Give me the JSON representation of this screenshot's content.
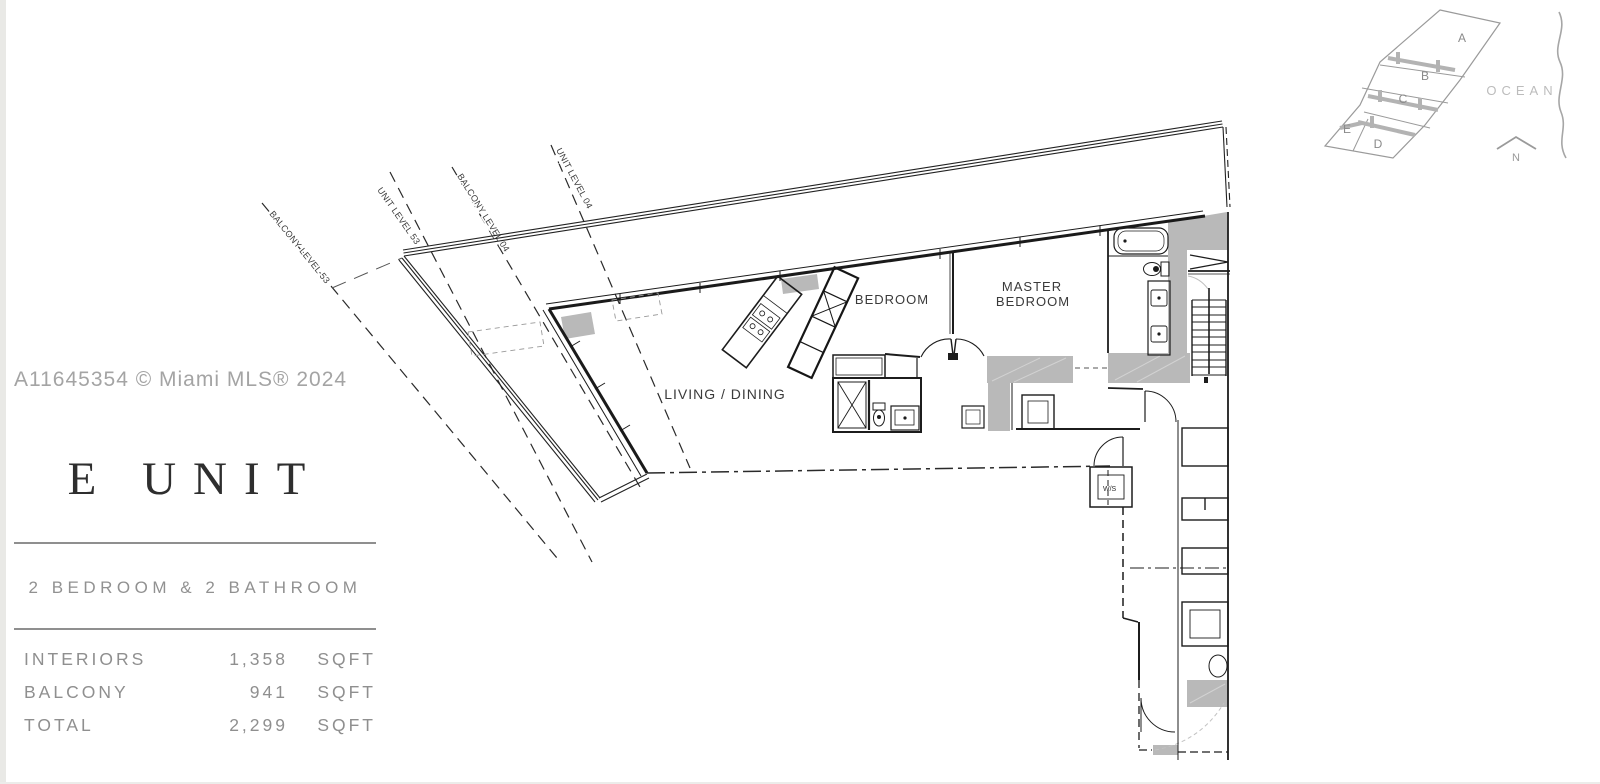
{
  "watermark_text": "A11645354 © Miami MLS® 2024",
  "title_block": {
    "unit_title": "E UNIT",
    "subtitle": "2 BEDROOM & 2 BATHROOM",
    "areas": [
      {
        "label": "INTERIORS",
        "value": "1,358",
        "unit": "SQFT"
      },
      {
        "label": "BALCONY",
        "value": "941",
        "unit": "SQFT"
      },
      {
        "label": "TOTAL",
        "value": "2,299",
        "unit": "SQFT"
      }
    ]
  },
  "key_map": {
    "unit_labels": [
      "A",
      "B",
      "C",
      "D",
      "E"
    ],
    "ocean_label": "OCEAN",
    "north_label": "N"
  },
  "floor_plan": {
    "room_labels": {
      "bedroom": "BEDROOM",
      "master_line1": "MASTER",
      "master_line2": "BEDROOM",
      "living_dining": "LIVING / DINING"
    },
    "reference_lines": [
      "BALCONY LEVEL 53",
      "UNIT LEVEL 53",
      "BALCONY LEVEL 04",
      "UNIT LEVEL 04"
    ],
    "utility_label": "W/S"
  },
  "colors": {
    "line": "#1f1f1f",
    "wall_fill": "#b9b9b9",
    "muted_text": "#8f8f8f",
    "keymap_gray": "#9a9a9a"
  }
}
